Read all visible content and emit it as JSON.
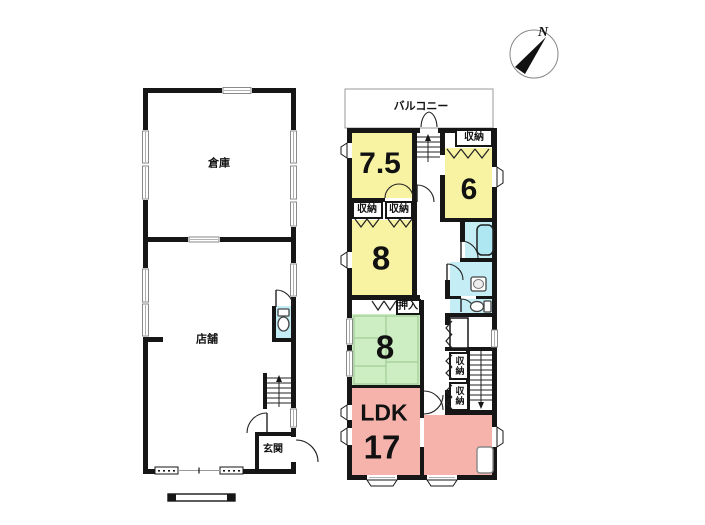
{
  "compass": {
    "north_label": "N"
  },
  "shop_building": {
    "warehouse_label": "倉庫",
    "store_label": "店舗",
    "entrance_label": "玄関"
  },
  "house": {
    "balcony_label": "バルコニー",
    "storage_top_label": "収納",
    "room_75_label": "7.5",
    "room_6_label": "6",
    "storage_a_label": "収納",
    "storage_b_label": "収納",
    "room_8_upper_label": "8",
    "oshiire_label": "押入",
    "room_8_tatami_label": "8",
    "hall_storage_1_label": "収納",
    "hall_storage_2_label": "収納",
    "ldk_label": "LDK",
    "ldk_size_label": "17"
  },
  "colors": {
    "room_yellow": "#f8f2a3",
    "room_green": "#cdedc3",
    "room_pink": "#f5b3ac",
    "wet_area_cyan": "#c4edf5",
    "bathtub_cyan": "#aee7f2",
    "wall_black": "#161616"
  }
}
